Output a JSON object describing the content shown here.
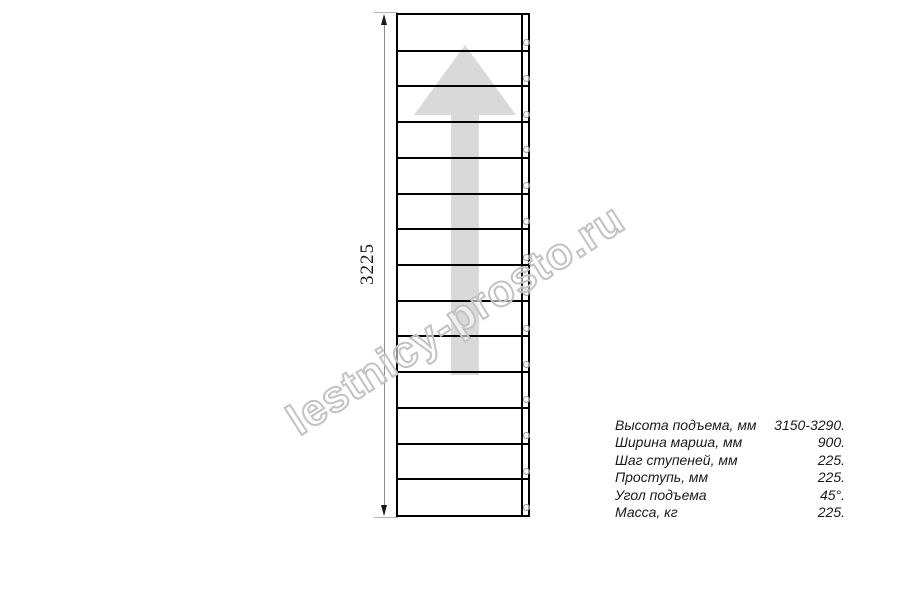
{
  "watermark": {
    "text": "lestnicy-prosto.ru"
  },
  "dimension": {
    "label": "3225"
  },
  "drawing": {
    "description": "staircase-flight-top-view",
    "steps": 14,
    "holes_per_step": 1
  },
  "specs": {
    "rows": [
      {
        "label": "Высота подъема, мм",
        "value": "3150-3290."
      },
      {
        "label": "Ширина марша, мм",
        "value": "900."
      },
      {
        "label": "Шаг ступеней, мм",
        "value": "225."
      },
      {
        "label": "Проступь, мм",
        "value": "225."
      },
      {
        "label": "Угол подъема",
        "value": "45°."
      },
      {
        "label": "Масса, кг",
        "value": "225."
      }
    ]
  },
  "icons": {
    "direction_arrow": "up-arrow",
    "dimension_arrows": "up-down-arrowheads",
    "holes": "screw-hole-circles"
  },
  "colors": {
    "line": "#000000",
    "dim_line": "#8c8c8c",
    "ext_line": "#b3b3b3",
    "arrow": "#d9d9d9",
    "circle": "#9e9e9e",
    "watermark_stroke": "#c2c2c2",
    "text": "#1a1a1a",
    "background": "#ffffff"
  }
}
